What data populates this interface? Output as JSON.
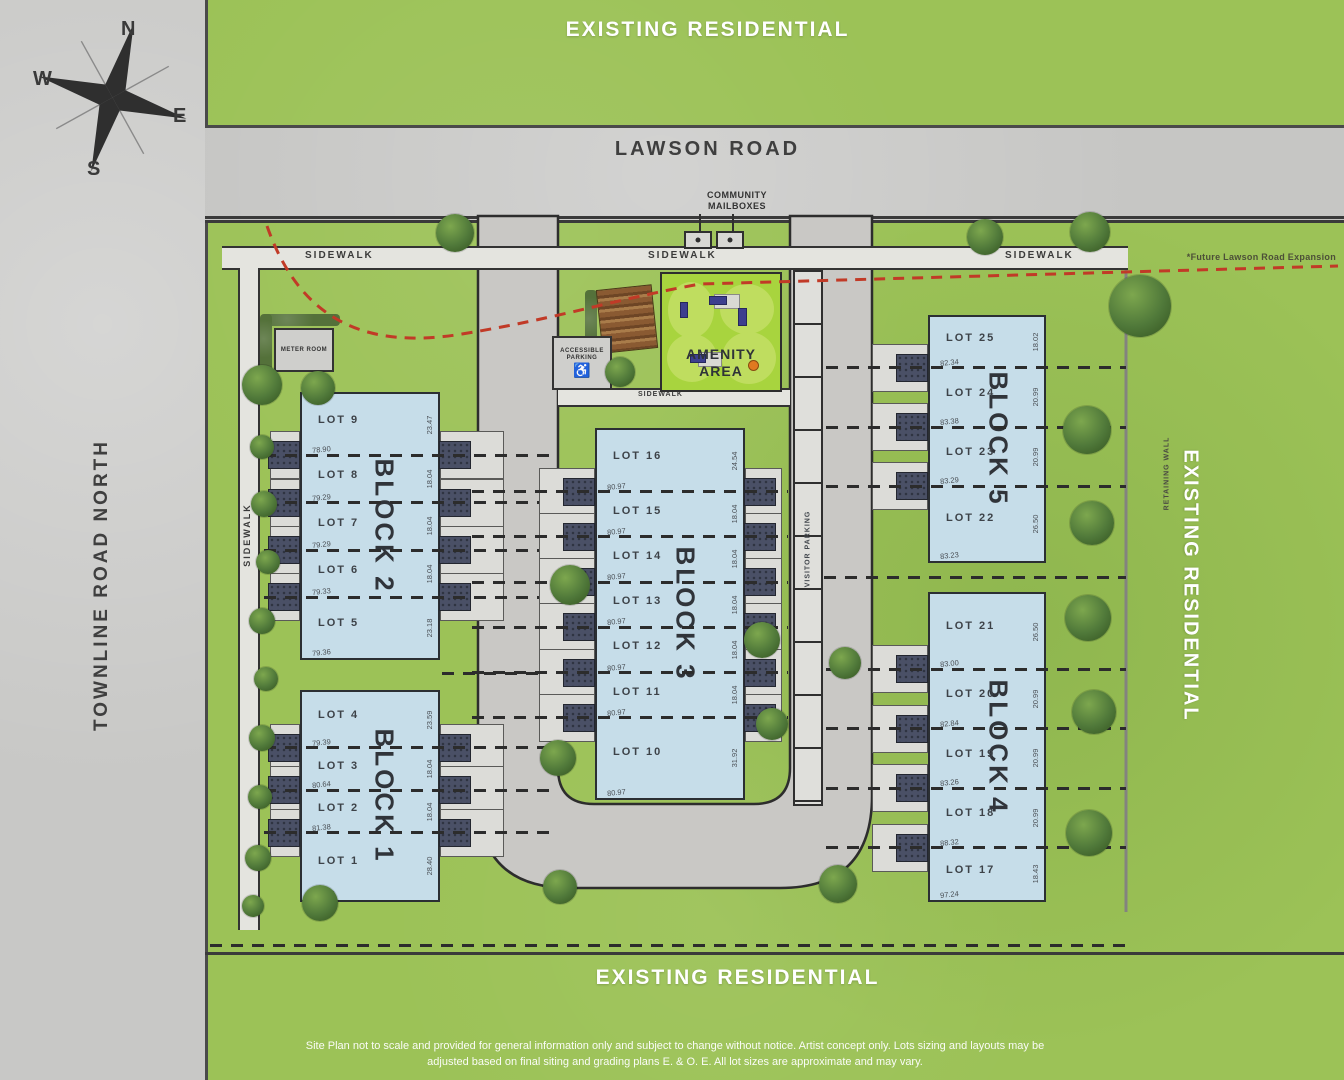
{
  "compass": {
    "n": "N",
    "e": "E",
    "s": "S",
    "w": "W"
  },
  "labels": {
    "existing_residential_top": "EXISTING RESIDENTIAL",
    "existing_residential_bottom": "EXISTING RESIDENTIAL",
    "existing_residential_right": "EXISTING RESIDENTIAL",
    "lawson_road": "LAWSON ROAD",
    "townline_road": "TOWNLINE ROAD NORTH",
    "future_expansion": "*Future Lawson Road Expansion",
    "community_mailboxes": "COMMUNITY MAILBOXES",
    "amenity_area": "AMENITY AREA",
    "accessible_parking": "ACCESSIBLE PARKING",
    "meter_room": "METER ROOM",
    "visitor_parking": "VISITOR PARKING",
    "retaining_wall": "RETAINING WALL",
    "sidewalk": "SIDEWALK"
  },
  "disclaimer": {
    "line1": "Site Plan not to scale and provided for general information only and subject to change without notice. Artist concept only. Lots sizing and layouts may be",
    "line2": "adjusted based on final siting and grading plans E. & O. E. All lot sizes are approximate and may vary."
  },
  "colors": {
    "grass": "#9cc257",
    "road": "#c8c7c4",
    "building": "#c6dde9",
    "amenity_green": "#a8d43e",
    "future_line_red": "#c13a27"
  },
  "blocks": [
    {
      "name": "BLOCK 2",
      "lots": [
        {
          "lot": "LOT 9",
          "left_dim": "78.90",
          "right_dim": "23.47"
        },
        {
          "lot": "LOT 8",
          "left_dim": "79.29",
          "right_dim": "18.04"
        },
        {
          "lot": "LOT 7",
          "left_dim": "79.29",
          "right_dim": "18.04"
        },
        {
          "lot": "LOT 6",
          "left_dim": "79.33",
          "right_dim": "18.04"
        },
        {
          "lot": "LOT 5",
          "left_dim": "79.36",
          "right_dim": "23.18"
        }
      ]
    },
    {
      "name": "BLOCK 1",
      "lots": [
        {
          "lot": "LOT 4",
          "left_dim": "79.39",
          "right_dim": "23.59"
        },
        {
          "lot": "LOT 3",
          "left_dim": "80.64",
          "right_dim": "18.04"
        },
        {
          "lot": "LOT 2",
          "left_dim": "81.38",
          "right_dim": "18.04"
        },
        {
          "lot": "LOT 1",
          "left_dim": "103.62",
          "right_dim": "28.40"
        }
      ]
    },
    {
      "name": "BLOCK 3",
      "lots": [
        {
          "lot": "LOT 16",
          "left_dim": "80.97",
          "right_dim": "24.54"
        },
        {
          "lot": "LOT 15",
          "left_dim": "80.97",
          "right_dim": "18.04"
        },
        {
          "lot": "LOT 14",
          "left_dim": "80.97",
          "right_dim": "18.04"
        },
        {
          "lot": "LOT 13",
          "left_dim": "80.97",
          "right_dim": "18.04"
        },
        {
          "lot": "LOT 12",
          "left_dim": "80.97",
          "right_dim": "18.04"
        },
        {
          "lot": "LOT 11",
          "left_dim": "80.97",
          "right_dim": "18.04"
        },
        {
          "lot": "LOT 10",
          "left_dim": "80.97",
          "right_dim": "31.92"
        }
      ]
    },
    {
      "name": "BLOCK 5",
      "lots": [
        {
          "lot": "LOT 25",
          "left_dim": "82.34",
          "right_dim": "18.02"
        },
        {
          "lot": "LOT 24",
          "left_dim": "83.38",
          "right_dim": "20.99"
        },
        {
          "lot": "LOT 23",
          "left_dim": "83.29",
          "right_dim": "20.99"
        },
        {
          "lot": "LOT 22",
          "left_dim": "83.23",
          "right_dim": "26.50"
        }
      ]
    },
    {
      "name": "BLOCK 4",
      "lots": [
        {
          "lot": "LOT 21",
          "left_dim": "83.00",
          "right_dim": "26.50"
        },
        {
          "lot": "LOT 20",
          "left_dim": "82.84",
          "right_dim": "20.99"
        },
        {
          "lot": "LOT 19",
          "left_dim": "83.26",
          "right_dim": "20.99"
        },
        {
          "lot": "LOT 18",
          "left_dim": "88.32",
          "right_dim": "20.99"
        },
        {
          "lot": "LOT 17",
          "left_dim": "97.24",
          "right_dim": "18.43"
        }
      ]
    }
  ]
}
